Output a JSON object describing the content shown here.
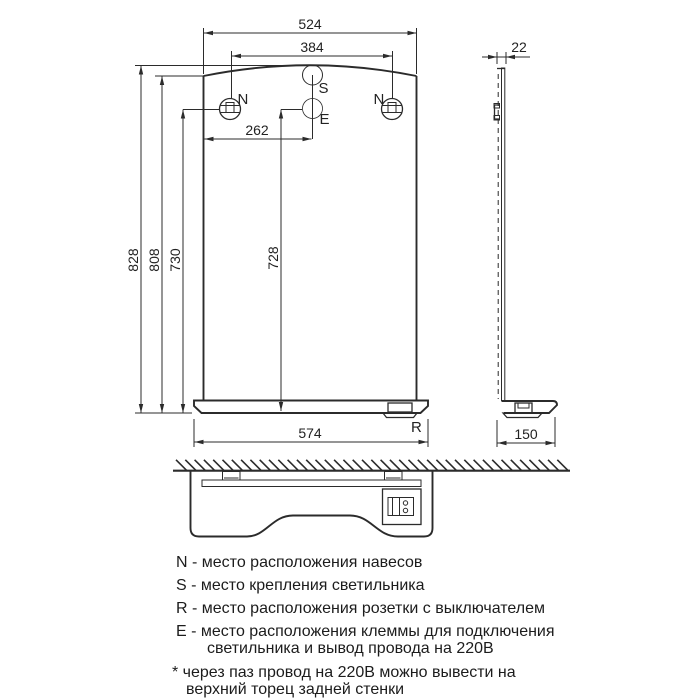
{
  "front_view": {
    "dim_width_top": "524",
    "dim_hanger_span": "384",
    "dim_center_offset": "262",
    "dim_height_total": "828",
    "dim_height_side": "808",
    "dim_height_hanger": "730",
    "dim_height_terminal": "728",
    "dim_width_shelf": "574",
    "label_hanger_left": "N",
    "label_hanger_right": "N",
    "label_lamp": "S",
    "label_terminal": "E",
    "label_socket": "R"
  },
  "side_view": {
    "dim_thickness": "22",
    "dim_depth": "150"
  },
  "legend": {
    "lines": [
      "N - место расположения навесов",
      "S - место крепления светильника",
      "R - место расположения розетки с выключателем",
      "E - место расположения клеммы для подключения",
      "светильника и вывод провода на 220В",
      "* через паз провод на 220В можно вывести на",
      "верхний торец задней стенки"
    ]
  },
  "colors": {
    "lamp_marker": "#4fa3e3",
    "lamp_marker_edge": "#2e6da4",
    "terminal_left": "#f5a623",
    "terminal_right": "#2ecc2e"
  }
}
